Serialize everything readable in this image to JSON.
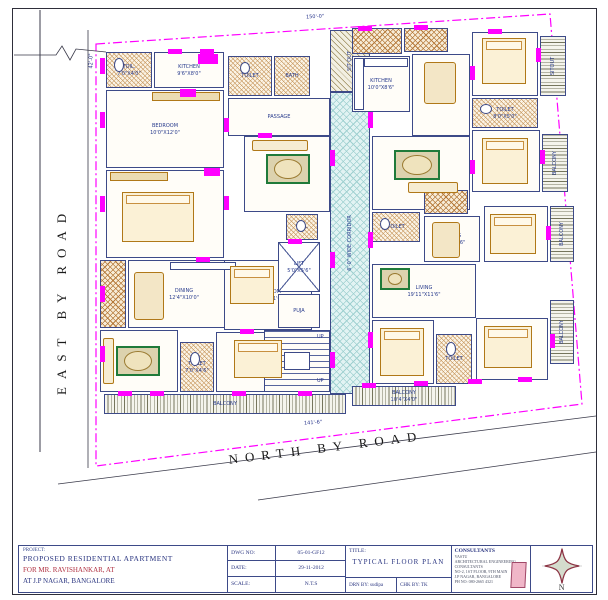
{
  "title_block": {
    "project_label": "PROJECT:",
    "project_name": "PROPOSED RESIDENTIAL APARTMENT",
    "client": "FOR MR. RAVISHANKAR, AT",
    "location": "AT J.P NAGAR, BANGALORE",
    "dwg_no_label": "DWG NO:",
    "dwg_no": "05-01-GF12",
    "date_label": "DATE:",
    "date": "29-11-2012",
    "scale_label": "SCALE:",
    "scale": "N.T.S",
    "title_label": "TITLE:",
    "drawing_title": "TYPICAL FLOOR PLAN",
    "drawn_by": "DRN BY: sudipa",
    "checked_by": "CHK BY: TK",
    "consultants_label": "CONSULTANTS",
    "consultants_lines": [
      "VASTU",
      "ARCHITECTURAL ENGINEERING CONSULTANTS",
      "NO-2, 1ST FLOOR, 9TH MAIN",
      "J.P NAGAR, BANGALORE",
      "PH NO: 080-2665 4321"
    ],
    "compass_label": "N"
  },
  "colors": {
    "wall": "#3d4a88",
    "opening_marker": "#ff00ff",
    "furniture": "#b07818",
    "rug_green": "#1f7a3a",
    "corridor_fill": "#e2f3f3",
    "accent_red": "#b03040",
    "boundary": "#ff00ff"
  },
  "drawing": {
    "roads": {
      "east": "EAST BY ROAD",
      "north": "NORTH BY ROAD"
    },
    "dim_labels": [
      {
        "t": "150'-0\"",
        "x": 306,
        "y": 14,
        "r": -3
      },
      {
        "t": "42'-0\"",
        "x": 84,
        "y": 58,
        "r": -90
      },
      {
        "t": "141'-6\"",
        "x": 304,
        "y": 420,
        "r": -4
      },
      {
        "t": "UP",
        "x": 317,
        "y": 334,
        "r": 0
      },
      {
        "t": "UP",
        "x": 317,
        "y": 378,
        "r": 0
      }
    ],
    "rooms": [
      {
        "label": "TOIL.",
        "dims": "7'0\"X4'0\"",
        "x": 106,
        "y": 52,
        "w": 46,
        "h": 36,
        "fill": "toilet"
      },
      {
        "label": "KITCHEN",
        "dims": "9'6\"X8'0\"",
        "x": 154,
        "y": 52,
        "w": 70,
        "h": 36,
        "fill": "plain"
      },
      {
        "label": "BEDROOM",
        "dims": "10'0\"X12'0\"",
        "x": 106,
        "y": 90,
        "w": 118,
        "h": 78,
        "fill": "plain"
      },
      {
        "label": "BEDROOM",
        "dims": "10'0\"X13'0\"",
        "x": 106,
        "y": 170,
        "w": 118,
        "h": 88,
        "fill": "plain"
      },
      {
        "label": "",
        "dims": "",
        "x": 100,
        "y": 260,
        "w": 26,
        "h": 68,
        "fill": "kitchen"
      },
      {
        "label": "DINING",
        "dims": "12'4\"X10'0\"",
        "x": 128,
        "y": 260,
        "w": 112,
        "h": 68,
        "fill": "plain"
      },
      {
        "label": "LIVING",
        "dims": "12'4\"X12'0\"",
        "x": 100,
        "y": 330,
        "w": 78,
        "h": 62,
        "fill": "plain"
      },
      {
        "label": "TOILET",
        "dims": "7'0\"X4'6\"",
        "x": 180,
        "y": 342,
        "w": 34,
        "h": 50,
        "fill": "toilet"
      },
      {
        "label": "BEDROOM",
        "dims": "10'0\"X11'6\"",
        "x": 224,
        "y": 260,
        "w": 88,
        "h": 70,
        "fill": "plain"
      },
      {
        "label": "BEDROOM",
        "dims": "10'0\"X11'6\"",
        "x": 216,
        "y": 332,
        "w": 100,
        "h": 60,
        "fill": "plain"
      },
      {
        "label": "BALCONY",
        "dims": "",
        "x": 104,
        "y": 394,
        "w": 242,
        "h": 20,
        "fill": "balc-v"
      },
      {
        "label": "TOILET",
        "dims": "",
        "x": 228,
        "y": 56,
        "w": 44,
        "h": 40,
        "fill": "toilet"
      },
      {
        "label": "BATH",
        "dims": "",
        "x": 274,
        "y": 56,
        "w": 36,
        "h": 40,
        "fill": "toilet"
      },
      {
        "label": "PASSAGE",
        "dims": "",
        "x": 228,
        "y": 98,
        "w": 102,
        "h": 38,
        "fill": "plain"
      },
      {
        "label": "LIVING",
        "dims": "12'0\"X11'0\"",
        "x": 244,
        "y": 136,
        "w": 86,
        "h": 76,
        "fill": "plain"
      },
      {
        "label": "TOIL.",
        "dims": "",
        "x": 286,
        "y": 214,
        "w": 32,
        "h": 26,
        "fill": "toilet"
      },
      {
        "label": "LIFT",
        "dims": "5'0\"X5'6\"",
        "x": 278,
        "y": 242,
        "w": 42,
        "h": 50,
        "fill": "lift"
      },
      {
        "label": "PUJA",
        "dims": "",
        "x": 278,
        "y": 294,
        "w": 42,
        "h": 34,
        "fill": "plain"
      },
      {
        "label": "",
        "dims": "",
        "x": 264,
        "y": 330,
        "w": 66,
        "h": 62,
        "fill": "stair"
      },
      {
        "label": "6'-0\" WIDE CORRIDOR",
        "dims": "",
        "x": 330,
        "y": 92,
        "w": 40,
        "h": 302,
        "fill": "corridor",
        "rot": 90
      },
      {
        "label": "SIT OUT",
        "dims": "",
        "x": 330,
        "y": 30,
        "w": 40,
        "h": 62,
        "fill": "diag",
        "rot": 90
      },
      {
        "label": "",
        "dims": "",
        "x": 352,
        "y": 28,
        "w": 50,
        "h": 26,
        "fill": "kitchen"
      },
      {
        "label": "",
        "dims": "",
        "x": 404,
        "y": 28,
        "w": 44,
        "h": 24,
        "fill": "kitchen"
      },
      {
        "label": "KITCHEN",
        "dims": "10'0\"X8'6\"",
        "x": 352,
        "y": 56,
        "w": 58,
        "h": 56,
        "fill": "plain"
      },
      {
        "label": "DINING",
        "dims": "12'0\"X10'0\"",
        "x": 412,
        "y": 54,
        "w": 58,
        "h": 82,
        "fill": "plain"
      },
      {
        "label": "W.BEDROOM",
        "dims": "10'0\"X12'0\"",
        "x": 472,
        "y": 32,
        "w": 66,
        "h": 64,
        "fill": "plain"
      },
      {
        "label": "SITOUT",
        "dims": "",
        "x": 540,
        "y": 36,
        "w": 26,
        "h": 60,
        "fill": "balc-h",
        "rot": 90
      },
      {
        "label": "TOILET",
        "dims": "8'0\"X5'0\"",
        "x": 472,
        "y": 98,
        "w": 66,
        "h": 30,
        "fill": "toilet"
      },
      {
        "label": "M.BEDROOM",
        "dims": "12'0\"X10'0\"",
        "x": 472,
        "y": 130,
        "w": 68,
        "h": 62,
        "fill": "plain"
      },
      {
        "label": "BALCONY",
        "dims": "",
        "x": 542,
        "y": 134,
        "w": 26,
        "h": 58,
        "fill": "balc-h",
        "rot": 90
      },
      {
        "label": "LIVING",
        "dims": "19'5\"X11'6\"",
        "x": 372,
        "y": 136,
        "w": 98,
        "h": 74,
        "fill": "plain"
      },
      {
        "label": "TOILET",
        "dims": "",
        "x": 372,
        "y": 212,
        "w": 48,
        "h": 30,
        "fill": "toilet"
      },
      {
        "label": "",
        "dims": "",
        "x": 424,
        "y": 190,
        "w": 44,
        "h": 24,
        "fill": "kitchen"
      },
      {
        "label": "DINING",
        "dims": "10'0\"X9'6\"",
        "x": 424,
        "y": 216,
        "w": 56,
        "h": 46,
        "fill": "plain"
      },
      {
        "label": "BEDROOM",
        "dims": "10'0\"X11'6\"",
        "x": 484,
        "y": 206,
        "w": 64,
        "h": 56,
        "fill": "plain"
      },
      {
        "label": "BALCONY",
        "dims": "",
        "x": 550,
        "y": 206,
        "w": 24,
        "h": 56,
        "fill": "balc-h",
        "rot": 90
      },
      {
        "label": "LIVING",
        "dims": "19'11\"X11'6\"",
        "x": 372,
        "y": 264,
        "w": 104,
        "h": 54,
        "fill": "plain"
      },
      {
        "label": "BEDROOM",
        "dims": "10'0\"X11'6\"",
        "x": 372,
        "y": 320,
        "w": 62,
        "h": 64,
        "fill": "plain"
      },
      {
        "label": "TOILET",
        "dims": "",
        "x": 436,
        "y": 334,
        "w": 36,
        "h": 50,
        "fill": "toilet"
      },
      {
        "label": "BEDROOM",
        "dims": "10'6\"X11'6\"",
        "x": 476,
        "y": 318,
        "w": 72,
        "h": 62,
        "fill": "plain"
      },
      {
        "label": "BALCONY",
        "dims": "10'4\"X4'0\"",
        "x": 352,
        "y": 386,
        "w": 104,
        "h": 20,
        "fill": "balc-v"
      },
      {
        "label": "BALCONY",
        "dims": "",
        "x": 550,
        "y": 300,
        "w": 24,
        "h": 64,
        "fill": "balc-h",
        "rot": 90
      }
    ],
    "furniture": [
      {
        "t": "ward",
        "x": 152,
        "y": 92,
        "w": 68,
        "h": 9
      },
      {
        "t": "bed",
        "x": 122,
        "y": 192,
        "w": 72,
        "h": 50
      },
      {
        "t": "ward",
        "x": 110,
        "y": 172,
        "w": 58,
        "h": 9
      },
      {
        "t": "table",
        "x": 134,
        "y": 272,
        "w": 30,
        "h": 48
      },
      {
        "t": "counter",
        "x": 170,
        "y": 262,
        "w": 66,
        "h": 8
      },
      {
        "t": "rug",
        "x": 116,
        "y": 346,
        "w": 44,
        "h": 30
      },
      {
        "t": "sofa",
        "x": 103,
        "y": 338,
        "w": 11,
        "h": 46
      },
      {
        "t": "bed",
        "x": 230,
        "y": 266,
        "w": 44,
        "h": 38
      },
      {
        "t": "bed",
        "x": 234,
        "y": 340,
        "w": 48,
        "h": 38
      },
      {
        "t": "rug",
        "x": 266,
        "y": 154,
        "w": 44,
        "h": 30
      },
      {
        "t": "sofa",
        "x": 252,
        "y": 140,
        "w": 56,
        "h": 11
      },
      {
        "t": "landing",
        "x": 284,
        "y": 352,
        "w": 26,
        "h": 18
      },
      {
        "t": "counter",
        "x": 354,
        "y": 58,
        "w": 10,
        "h": 52
      },
      {
        "t": "counter",
        "x": 364,
        "y": 58,
        "w": 44,
        "h": 9
      },
      {
        "t": "table",
        "x": 424,
        "y": 62,
        "w": 32,
        "h": 42
      },
      {
        "t": "bed",
        "x": 482,
        "y": 38,
        "w": 44,
        "h": 46
      },
      {
        "t": "bed",
        "x": 482,
        "y": 138,
        "w": 46,
        "h": 46
      },
      {
        "t": "rug",
        "x": 394,
        "y": 150,
        "w": 46,
        "h": 30
      },
      {
        "t": "sofa",
        "x": 408,
        "y": 182,
        "w": 50,
        "h": 11
      },
      {
        "t": "table",
        "x": 432,
        "y": 222,
        "w": 28,
        "h": 36
      },
      {
        "t": "bed",
        "x": 490,
        "y": 214,
        "w": 46,
        "h": 40
      },
      {
        "t": "rug",
        "x": 380,
        "y": 268,
        "w": 30,
        "h": 22
      },
      {
        "t": "bed",
        "x": 380,
        "y": 328,
        "w": 44,
        "h": 48
      },
      {
        "t": "bed",
        "x": 484,
        "y": 326,
        "w": 48,
        "h": 42
      },
      {
        "t": "wc",
        "x": 114,
        "y": 58,
        "w": 10,
        "h": 14
      },
      {
        "t": "wc",
        "x": 190,
        "y": 352,
        "w": 10,
        "h": 14
      },
      {
        "t": "wc",
        "x": 296,
        "y": 220,
        "w": 10,
        "h": 12
      },
      {
        "t": "wc",
        "x": 380,
        "y": 218,
        "w": 10,
        "h": 12
      },
      {
        "t": "wc",
        "x": 446,
        "y": 342,
        "w": 10,
        "h": 14
      },
      {
        "t": "wc",
        "x": 480,
        "y": 104,
        "w": 12,
        "h": 10
      },
      {
        "t": "wc",
        "x": 240,
        "y": 62,
        "w": 10,
        "h": 12
      }
    ],
    "markers": [
      [
        100,
        58,
        5,
        16
      ],
      [
        100,
        112,
        5,
        16
      ],
      [
        100,
        196,
        5,
        16
      ],
      [
        100,
        286,
        5,
        16
      ],
      [
        100,
        346,
        5,
        16
      ],
      [
        224,
        118,
        5,
        14
      ],
      [
        224,
        196,
        5,
        14
      ],
      [
        330,
        150,
        5,
        16
      ],
      [
        330,
        252,
        5,
        16
      ],
      [
        330,
        352,
        5,
        16
      ],
      [
        368,
        112,
        5,
        16
      ],
      [
        368,
        232,
        5,
        16
      ],
      [
        368,
        332,
        5,
        16
      ],
      [
        536,
        48,
        5,
        14
      ],
      [
        540,
        150,
        5,
        14
      ],
      [
        546,
        226,
        5,
        14
      ],
      [
        550,
        334,
        5,
        14
      ],
      [
        470,
        66,
        5,
        14
      ],
      [
        470,
        160,
        5,
        14
      ],
      [
        168,
        49,
        14,
        5
      ],
      [
        200,
        49,
        14,
        5
      ],
      [
        358,
        26,
        14,
        5
      ],
      [
        414,
        25,
        14,
        5
      ],
      [
        488,
        29,
        14,
        5
      ],
      [
        118,
        391,
        14,
        5
      ],
      [
        150,
        391,
        14,
        5
      ],
      [
        232,
        391,
        14,
        5
      ],
      [
        298,
        391,
        14,
        5
      ],
      [
        362,
        383,
        14,
        5
      ],
      [
        414,
        381,
        14,
        5
      ],
      [
        468,
        379,
        14,
        5
      ],
      [
        518,
        377,
        14,
        5
      ],
      [
        196,
        257,
        14,
        5
      ],
      [
        258,
        133,
        14,
        5
      ],
      [
        288,
        239,
        14,
        5
      ],
      [
        240,
        329,
        14,
        5
      ],
      [
        198,
        54,
        20,
        10
      ],
      [
        180,
        89,
        16,
        8
      ],
      [
        204,
        168,
        16,
        8
      ]
    ]
  }
}
